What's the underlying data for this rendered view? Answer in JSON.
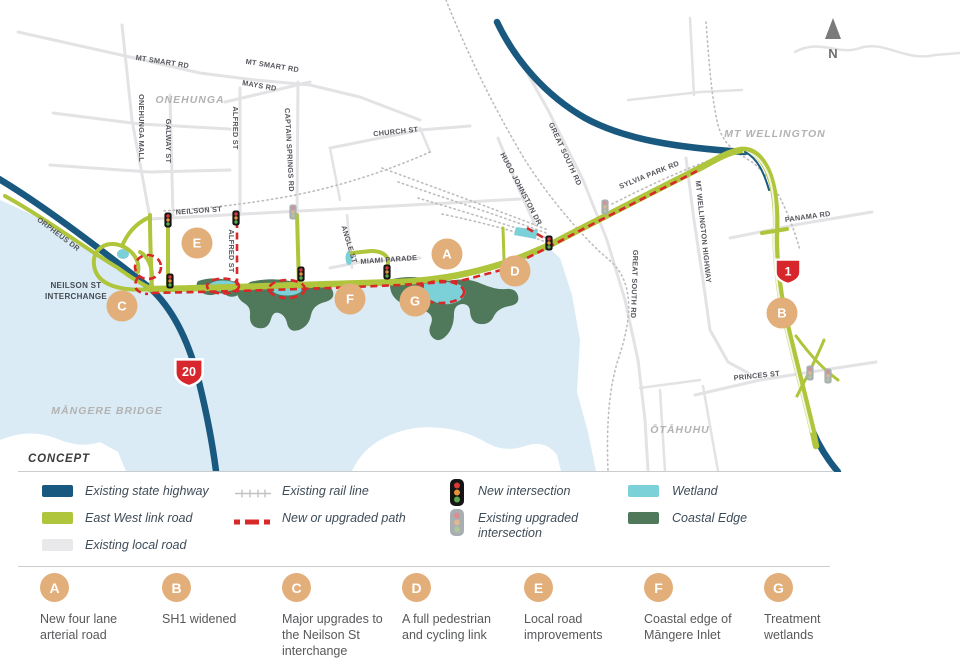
{
  "map": {
    "north_label": "N",
    "concept_label": "CONCEPT",
    "areas": [
      {
        "label": "ONEHUNGA"
      },
      {
        "label": "MT WELLINGTON"
      },
      {
        "label": "MĀNGERE BRIDGE"
      },
      {
        "label": "ŌTĀHUHU"
      }
    ],
    "streets": [
      {
        "label": "MT SMART RD"
      },
      {
        "label": "MT SMART RD"
      },
      {
        "label": "MAYS RD"
      },
      {
        "label": "CHURCH ST"
      },
      {
        "label": "ONEHUNGA MALL"
      },
      {
        "label": "GALWAY ST"
      },
      {
        "label": "ALFRED ST"
      },
      {
        "label": "CAPTAIN SPRINGS RD"
      },
      {
        "label": "NEILSON ST"
      },
      {
        "label": "ALFRED ST"
      },
      {
        "label": "ANGLE ST"
      },
      {
        "label": "MIAMI PARADE"
      },
      {
        "label": "HUGO JOHNSTON DR"
      },
      {
        "label": "GREAT SOUTH RD"
      },
      {
        "label": "GREAT SOUTH RD"
      },
      {
        "label": "SYLVIA PARK RD"
      },
      {
        "label": "MT WELLINGTON HIGHWAY"
      },
      {
        "label": "PANAMA RD"
      },
      {
        "label": "PRINCES ST"
      },
      {
        "label": "ORPHEUS DR"
      }
    ],
    "interchange": {
      "line1": "NEILSON ST",
      "line2": "INTERCHANGE"
    },
    "shields": {
      "sh20": "20",
      "sh1": "1"
    },
    "circles": [
      {
        "letter": "A"
      },
      {
        "letter": "B"
      },
      {
        "letter": "C"
      },
      {
        "letter": "D"
      },
      {
        "letter": "E"
      },
      {
        "letter": "F"
      },
      {
        "letter": "G"
      }
    ]
  },
  "legend": {
    "columns": [
      {
        "items": [
          {
            "type": "swatch",
            "color": "#19587f",
            "label": "Existing state highway"
          },
          {
            "type": "swatch",
            "color": "#afc53b",
            "label": "East West link road"
          },
          {
            "type": "swatch",
            "color": "#e9e9eb",
            "label": "Existing local road"
          }
        ]
      },
      {
        "items": [
          {
            "type": "rail",
            "label": "Existing rail line"
          },
          {
            "type": "dashed",
            "color": "#d8282a",
            "label": "New or upgraded path"
          }
        ]
      },
      {
        "items": [
          {
            "type": "traffic-new",
            "label": "New intersection"
          },
          {
            "type": "traffic-existing",
            "label": "Existing upgraded intersection"
          }
        ]
      },
      {
        "items": [
          {
            "type": "swatch",
            "color": "#7cd0d8",
            "label": "Wetland"
          },
          {
            "type": "swatch",
            "color": "#50795b",
            "label": "Coastal Edge"
          }
        ]
      }
    ]
  },
  "callouts": [
    {
      "letter": "A",
      "text": "New four lane arterial road"
    },
    {
      "letter": "B",
      "text": "SH1 widened"
    },
    {
      "letter": "C",
      "text": "Major upgrades to the Neilson St interchange"
    },
    {
      "letter": "D",
      "text": "A full pedestrian and cycling link"
    },
    {
      "letter": "E",
      "text": "Local road improvements"
    },
    {
      "letter": "F",
      "text": "Coastal edge of Māngere Inlet"
    },
    {
      "letter": "G",
      "text": "Treatment wetlands"
    }
  ]
}
